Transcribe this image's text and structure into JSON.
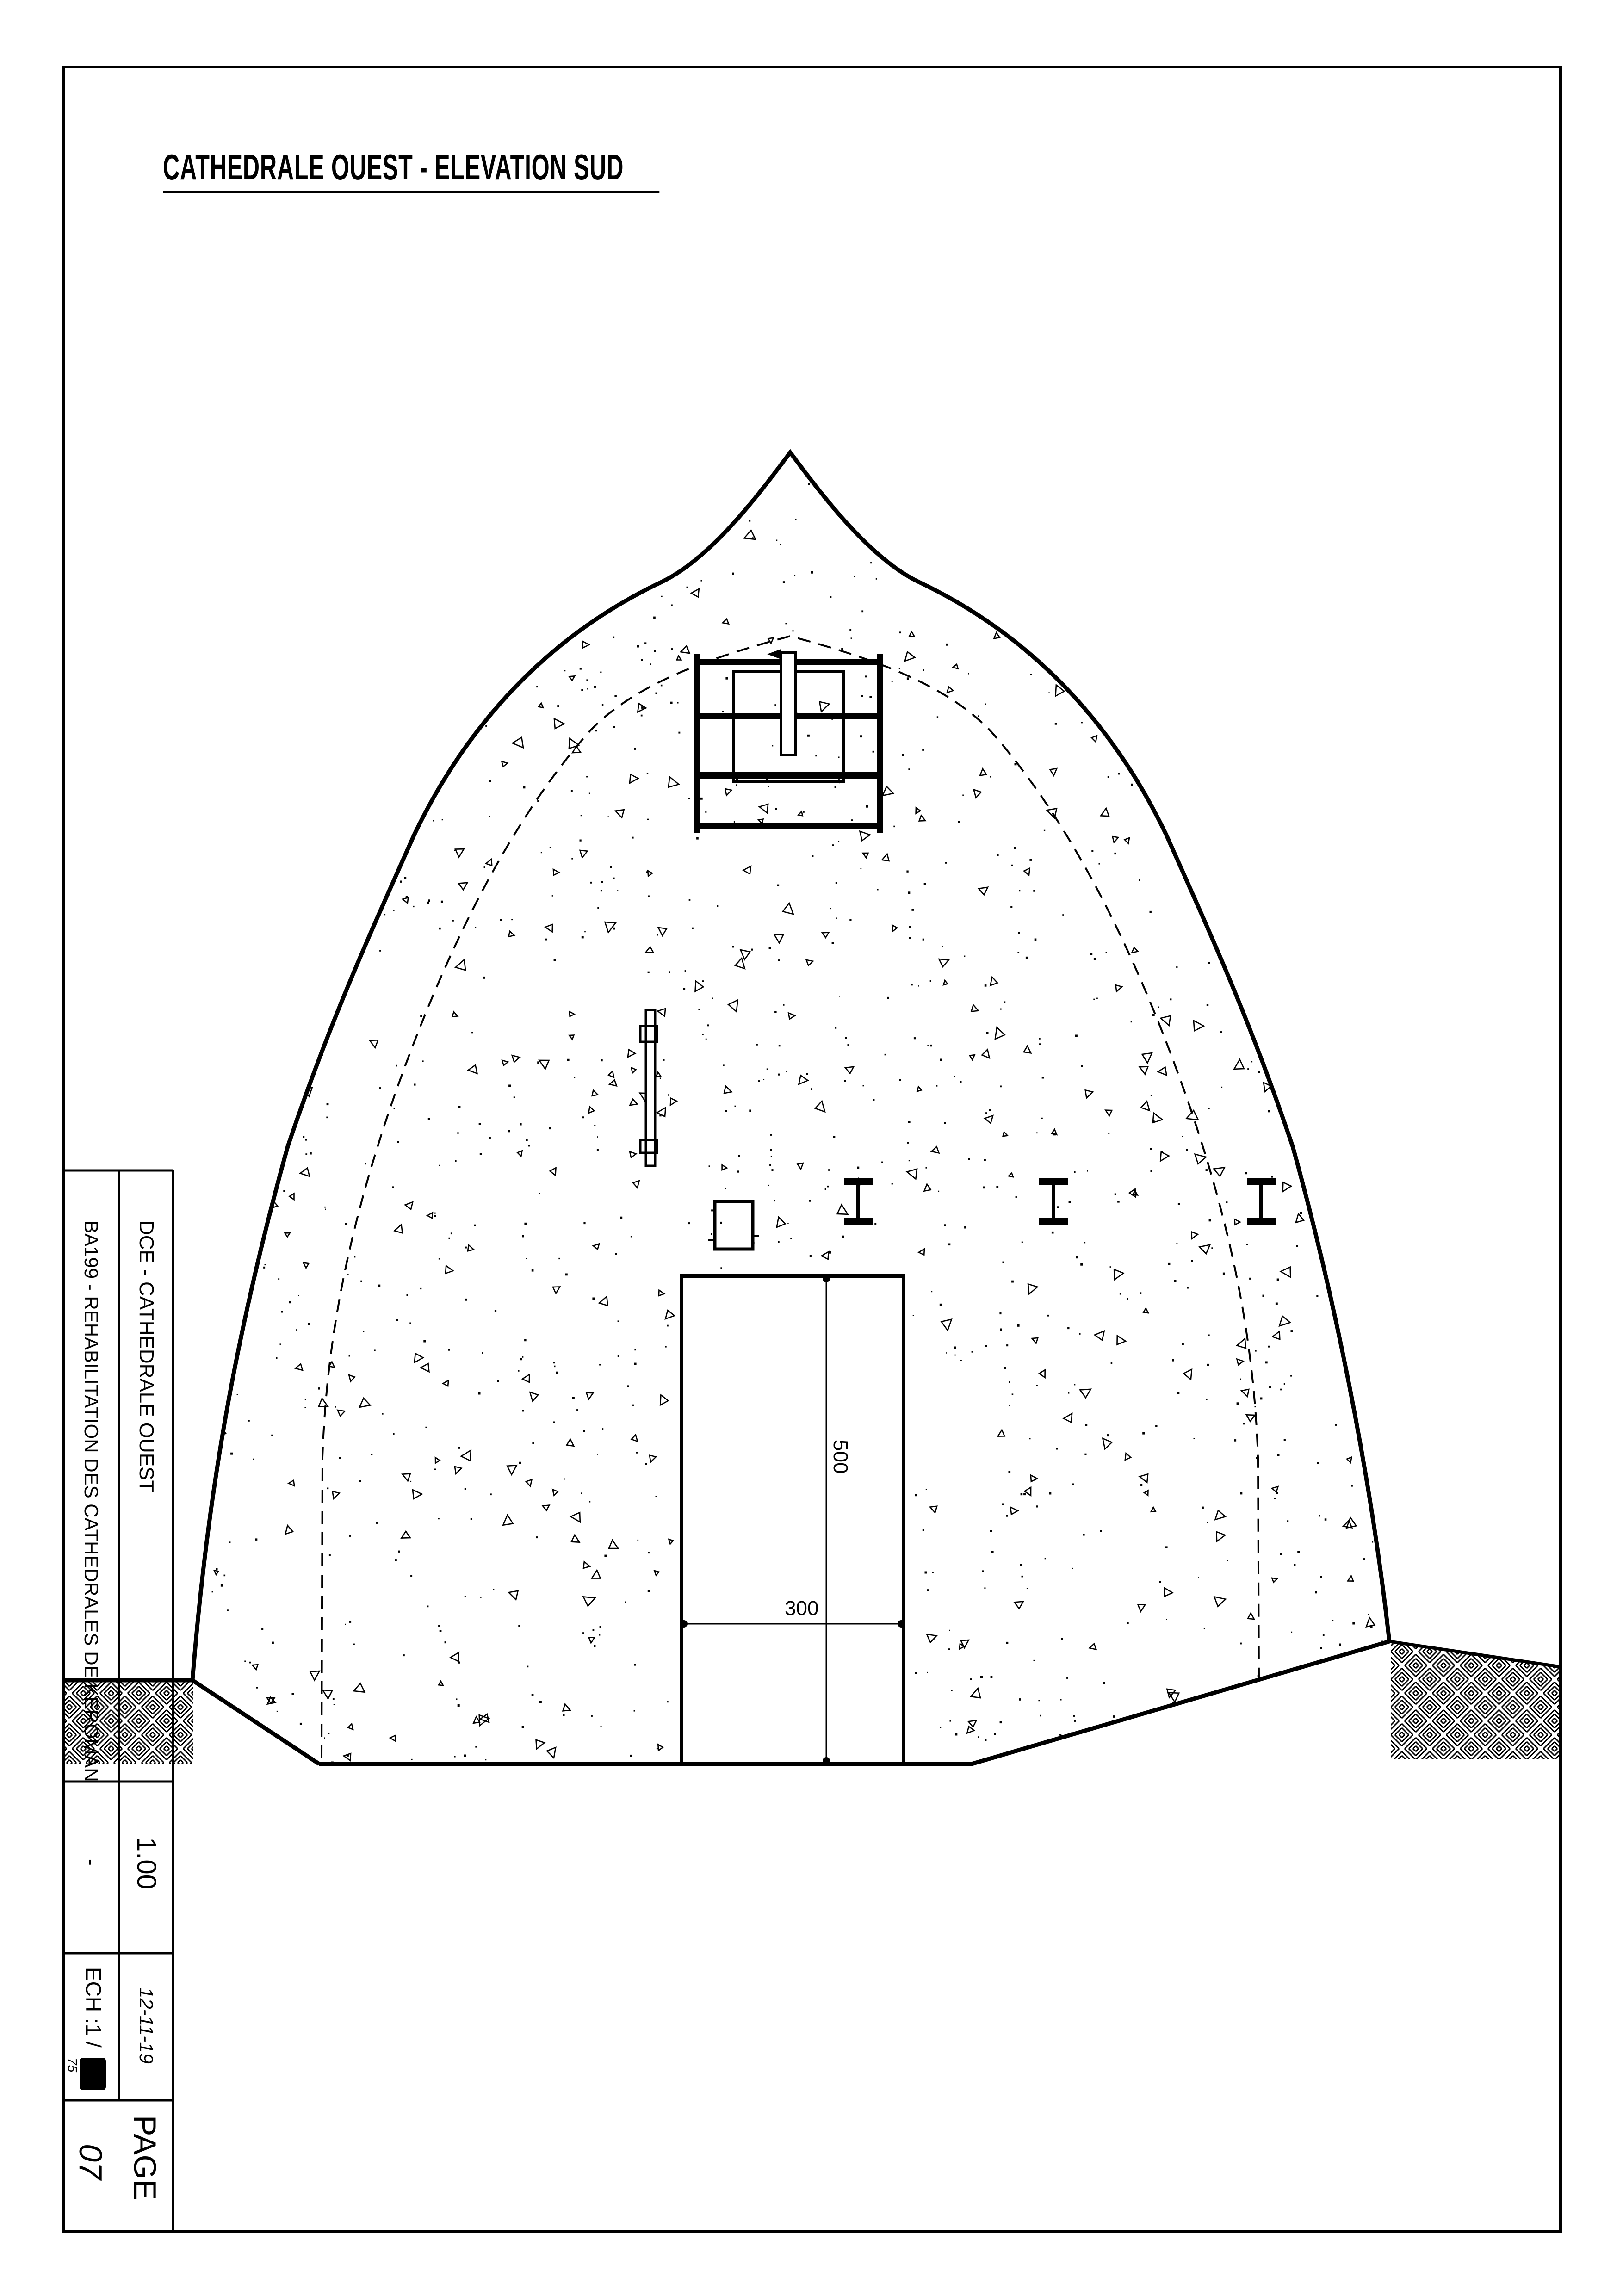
{
  "page": {
    "title": "CATHEDRALE OUEST - ELEVATION SUD"
  },
  "title_block": {
    "project": "BA199 - REHABILITATION DES CATHEDRALES DE KEROMAN",
    "document": "DCE - CATHEDRALE OUEST",
    "version": "1.00",
    "revision": "-",
    "scale_label": "ECH :1 /",
    "scale_denominator": "75",
    "date": "12-11-19",
    "page_label": "PAGE",
    "page_number": "07"
  },
  "dimensions": {
    "door_height": "500",
    "door_width": "300"
  },
  "colors": {
    "ink": "#000000",
    "paper": "#ffffff"
  }
}
